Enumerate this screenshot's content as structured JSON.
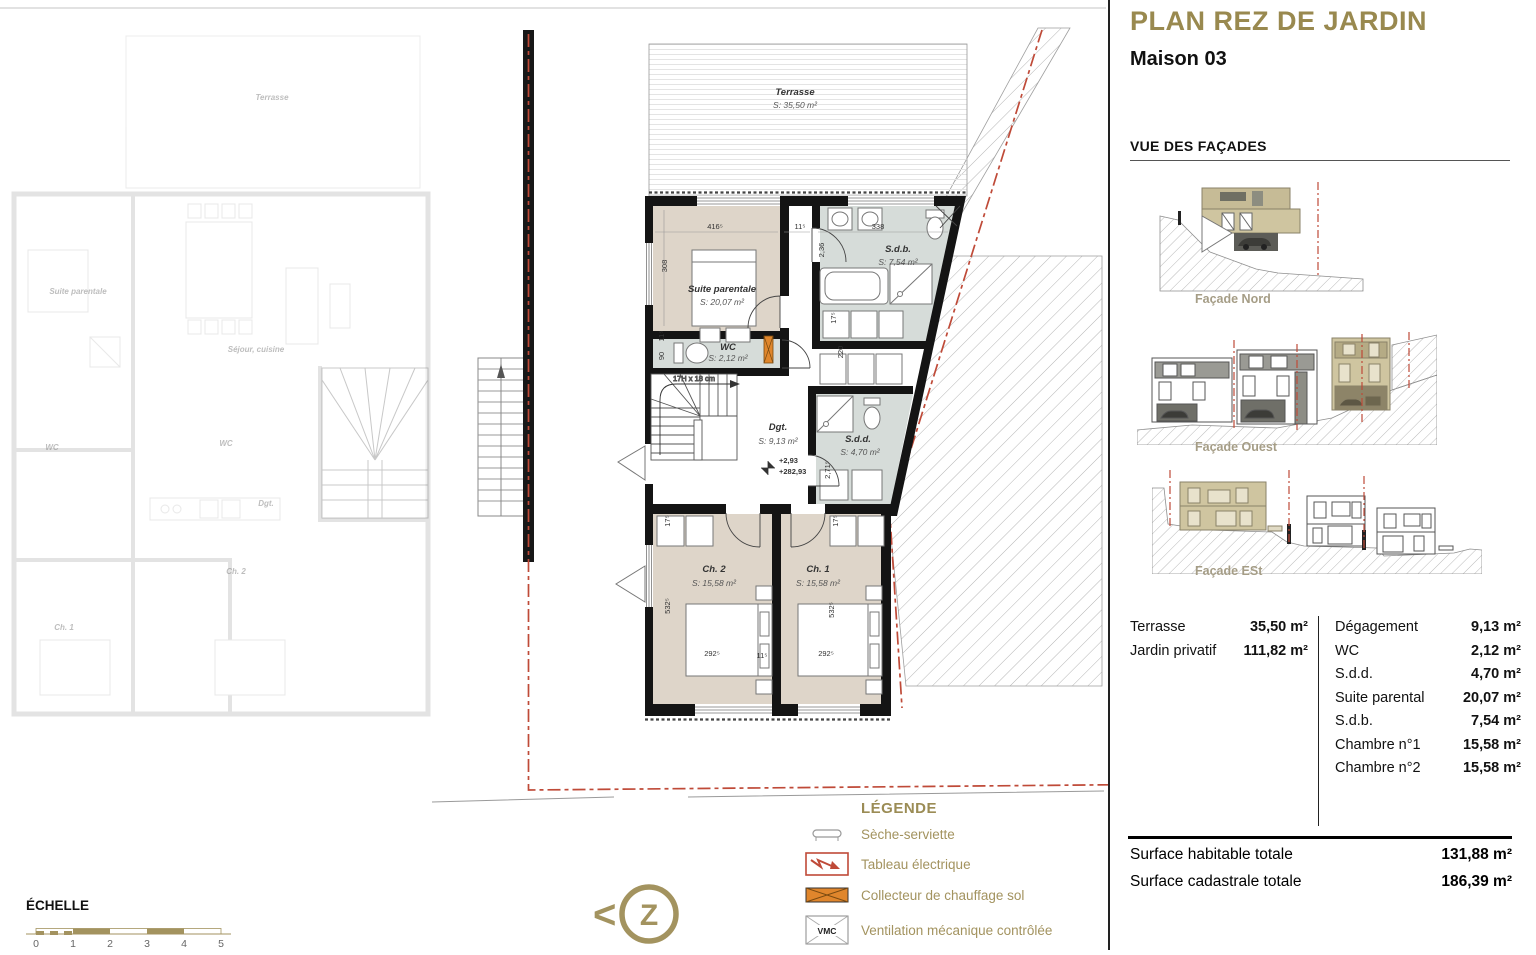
{
  "sheet": {
    "title": "PLAN REZ DE JARDIN",
    "subtitle": "Maison 03",
    "facades_heading": "VUE DES FAÇADES",
    "facade_labels": {
      "nord": "Façade Nord",
      "ouest": "Façade Ouest",
      "est": "Façade ESt"
    },
    "areas_left": [
      {
        "label": "Terrasse",
        "value": "35,50 m²"
      },
      {
        "label": "Jardin privatif",
        "value": "111,82 m²"
      }
    ],
    "areas_right": [
      {
        "label": "Dégagement",
        "value": "9,13 m²"
      },
      {
        "label": "WC",
        "value": "2,12 m²"
      },
      {
        "label": "S.d.d.",
        "value": "4,70 m²"
      },
      {
        "label": "Suite parental",
        "value": "20,07 m²"
      },
      {
        "label": "S.d.b.",
        "value": "7,54 m²"
      },
      {
        "label": "Chambre n°1",
        "value": "15,58 m²"
      },
      {
        "label": "Chambre n°2",
        "value": "15,58 m²"
      }
    ],
    "totals": [
      {
        "label": "Surface habitable totale",
        "value": "131,88 m²"
      },
      {
        "label": "Surface cadastrale totale",
        "value": "186,39 m²"
      }
    ]
  },
  "legend": {
    "heading": "LÉGENDE",
    "items": [
      {
        "label": "Sèche-serviette",
        "icon": "towel-dryer-icon"
      },
      {
        "label": "Tableau électrique",
        "icon": "electric-panel-icon"
      },
      {
        "label": "Collecteur de chauffage sol",
        "icon": "floor-heating-collector-icon"
      },
      {
        "label": "Ventilation mécanique contrôlée",
        "icon": "vmc-icon",
        "icon_text": "VMC"
      }
    ]
  },
  "scale": {
    "heading": "ÉCHELLE",
    "ticks": [
      "0",
      "1",
      "2",
      "3",
      "4",
      "5"
    ]
  },
  "compass": {
    "chevron": "<",
    "letter": "Z"
  },
  "plan": {
    "rooms": {
      "terrasse": {
        "name": "Terrasse",
        "area": "S: 35,50 m²"
      },
      "suite": {
        "name": "Suite parentale",
        "area": "S: 20,07 m²"
      },
      "sdb": {
        "name": "S.d.b.",
        "area": "S: 7,54 m²"
      },
      "wc": {
        "name": "WC",
        "area": "S: 2,12 m²"
      },
      "dgt": {
        "name": "Dgt.",
        "area": "S: 9,13 m²"
      },
      "sdd": {
        "name": "S.d.d.",
        "area": "S: 4,70 m²"
      },
      "ch2": {
        "name": "Ch. 2",
        "area": "S: 15,58 m²"
      },
      "ch1": {
        "name": "Ch. 1",
        "area": "S: 15,58 m²"
      }
    },
    "levels": {
      "relative": "+2,93",
      "absolute": "+282,93"
    },
    "stair_note": "17H x 18 cm",
    "dims": [
      "416⁵",
      "11⁵",
      "338",
      "308",
      "2,36",
      "17⁵",
      "220",
      "11⁵",
      "90",
      "2,71⁵",
      "17⁵",
      "17⁵",
      "532⁵",
      "532⁵",
      "292⁵",
      "11⁵",
      "292⁵"
    ]
  },
  "ghost": {
    "labels": [
      "Terrasse",
      "Suite parentale",
      "Séjour, cuisine",
      "WC",
      "WC",
      "Dgt.",
      "Ch. 1",
      "Ch. 2"
    ]
  },
  "colors": {
    "gold": "#99894f",
    "legend_gold": "#a3935f",
    "facade_label": "#a59d86",
    "boundary_red": "#bf4a38",
    "collector_orange": "#e0862c",
    "room_beige": "#ded5c9",
    "room_bath": "#d6dcd9",
    "wall": "#141414"
  }
}
